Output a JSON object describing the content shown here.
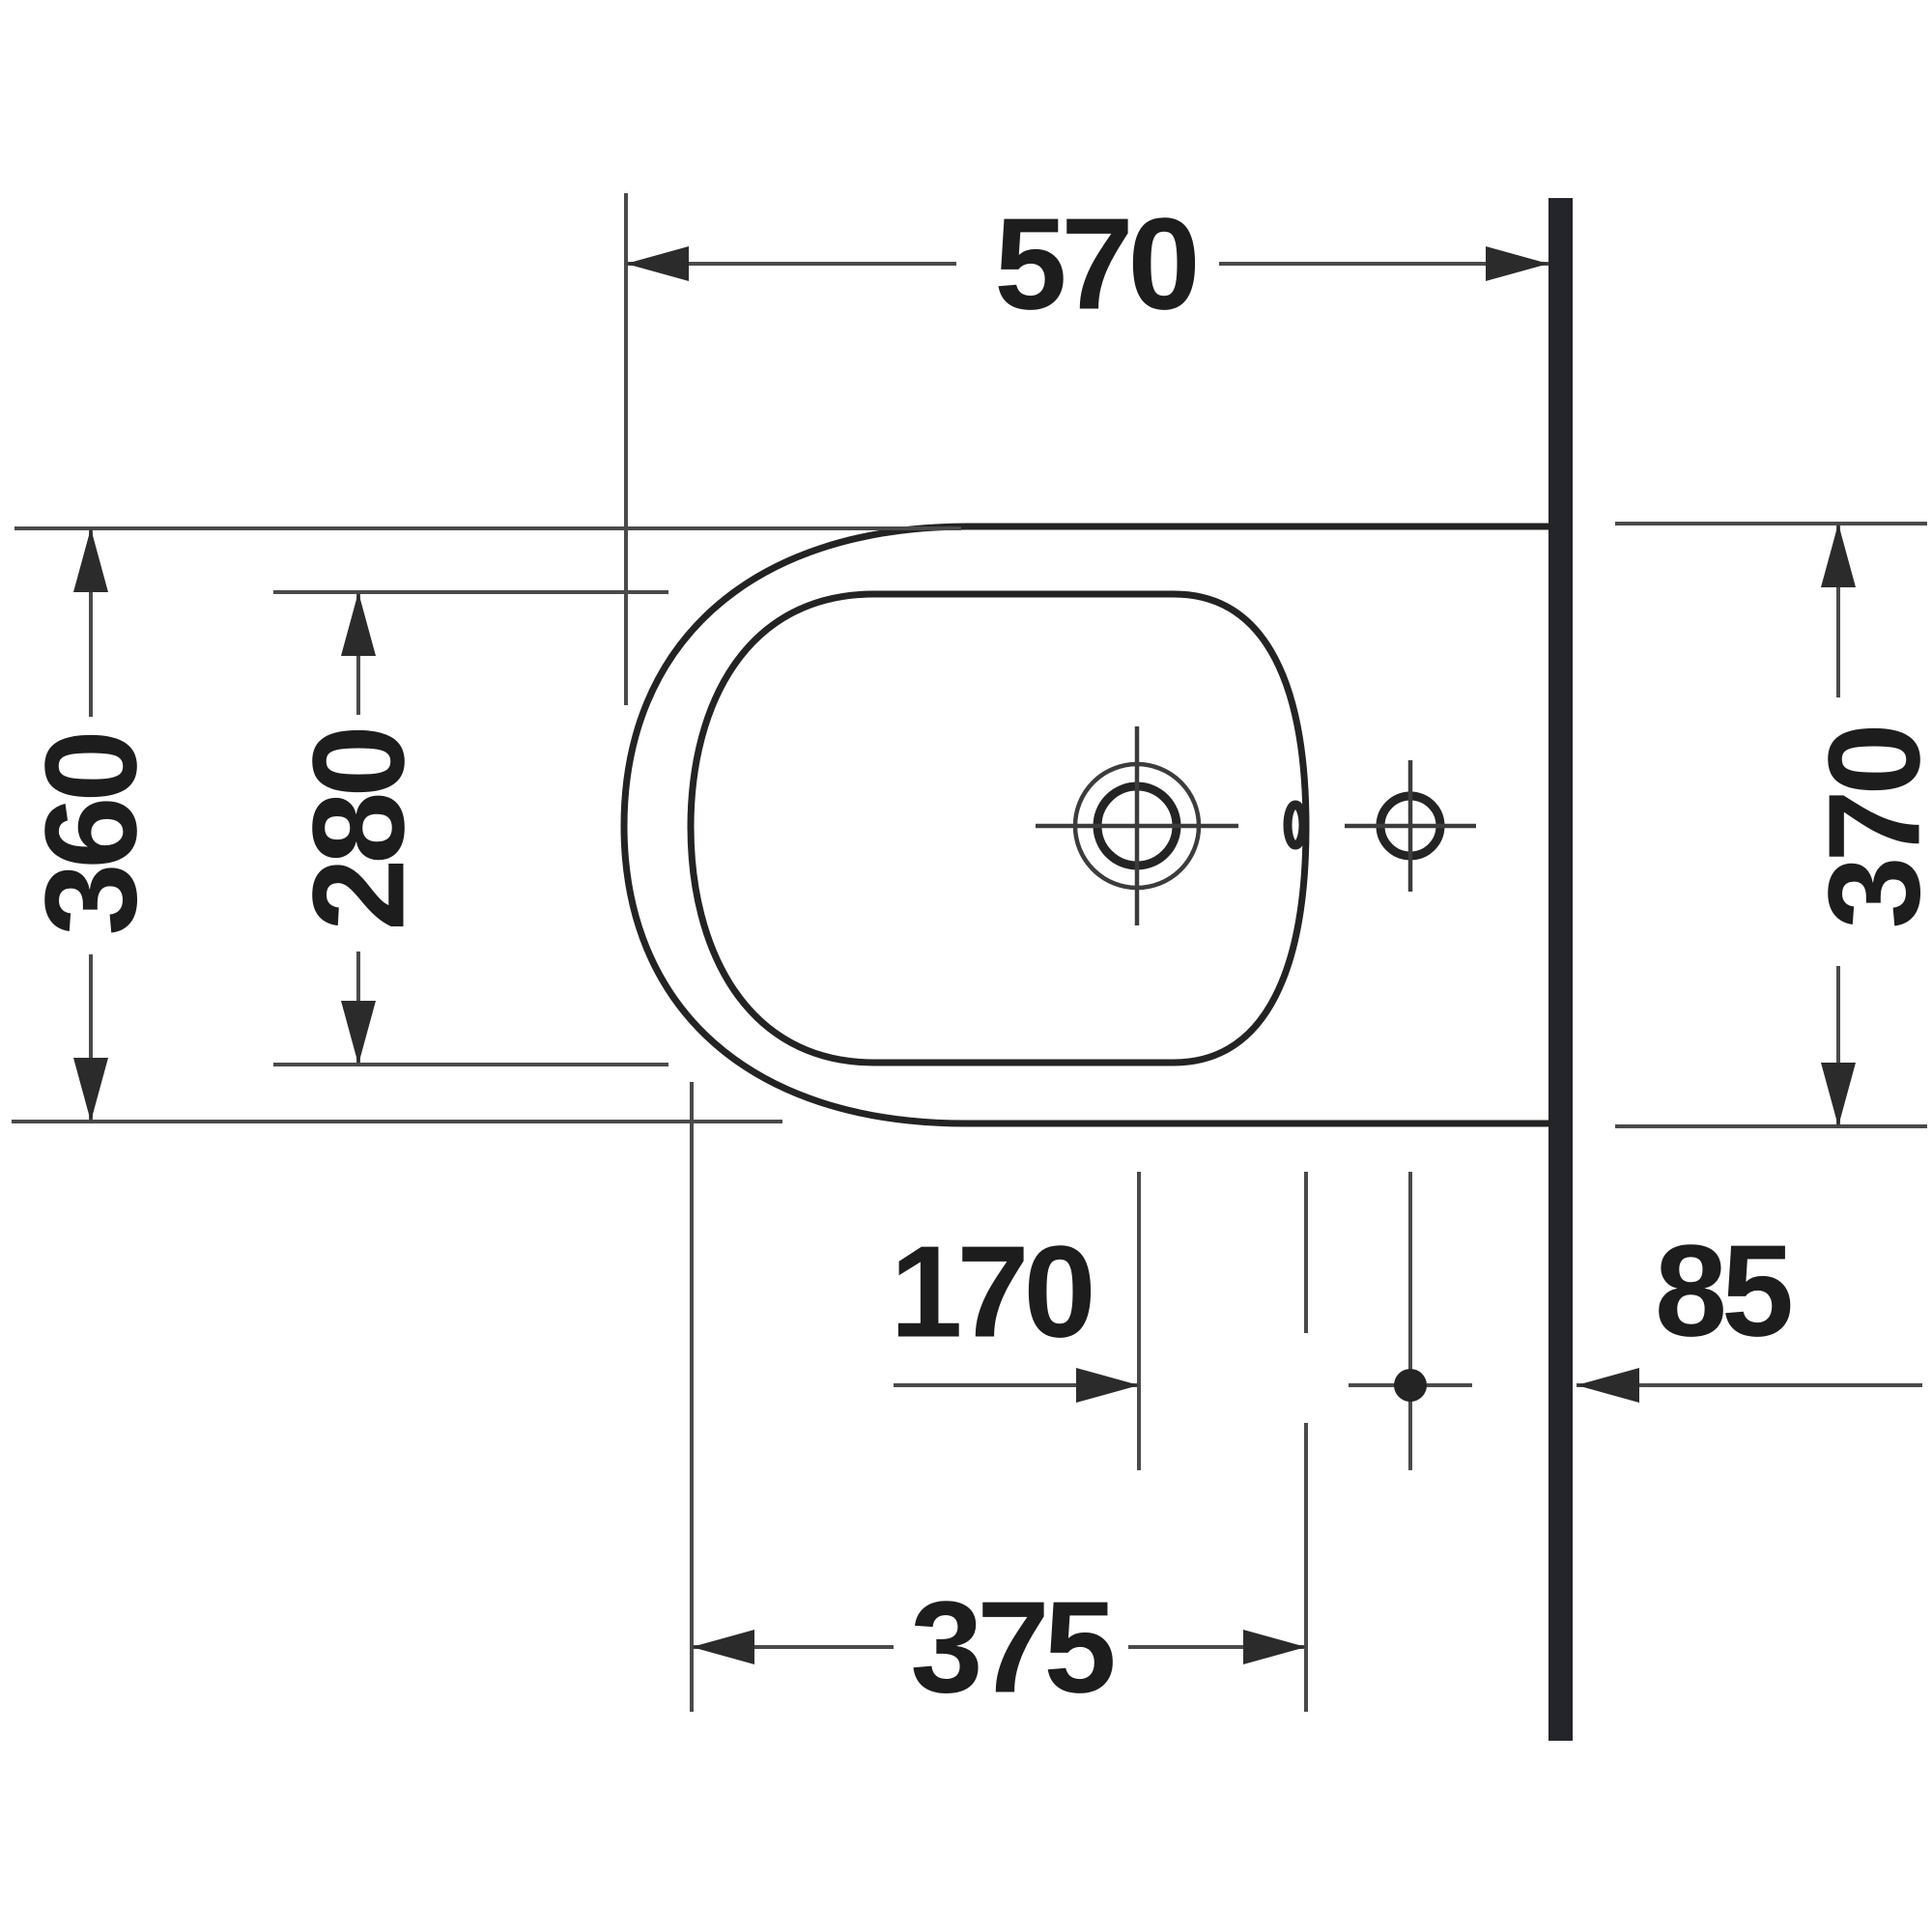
{
  "dimensions": {
    "overall_depth": "570",
    "front_width": "360",
    "bowl_width": "280",
    "back_width": "370",
    "tap_to_hole": "170",
    "hole_to_wall": "85",
    "bowl_length": "375"
  },
  "colors": {
    "outline": "#232323",
    "dimension_lines": "#4a4a4a",
    "text": "#1d1d1d",
    "wall": "#24252a",
    "background": "#ffffff"
  }
}
